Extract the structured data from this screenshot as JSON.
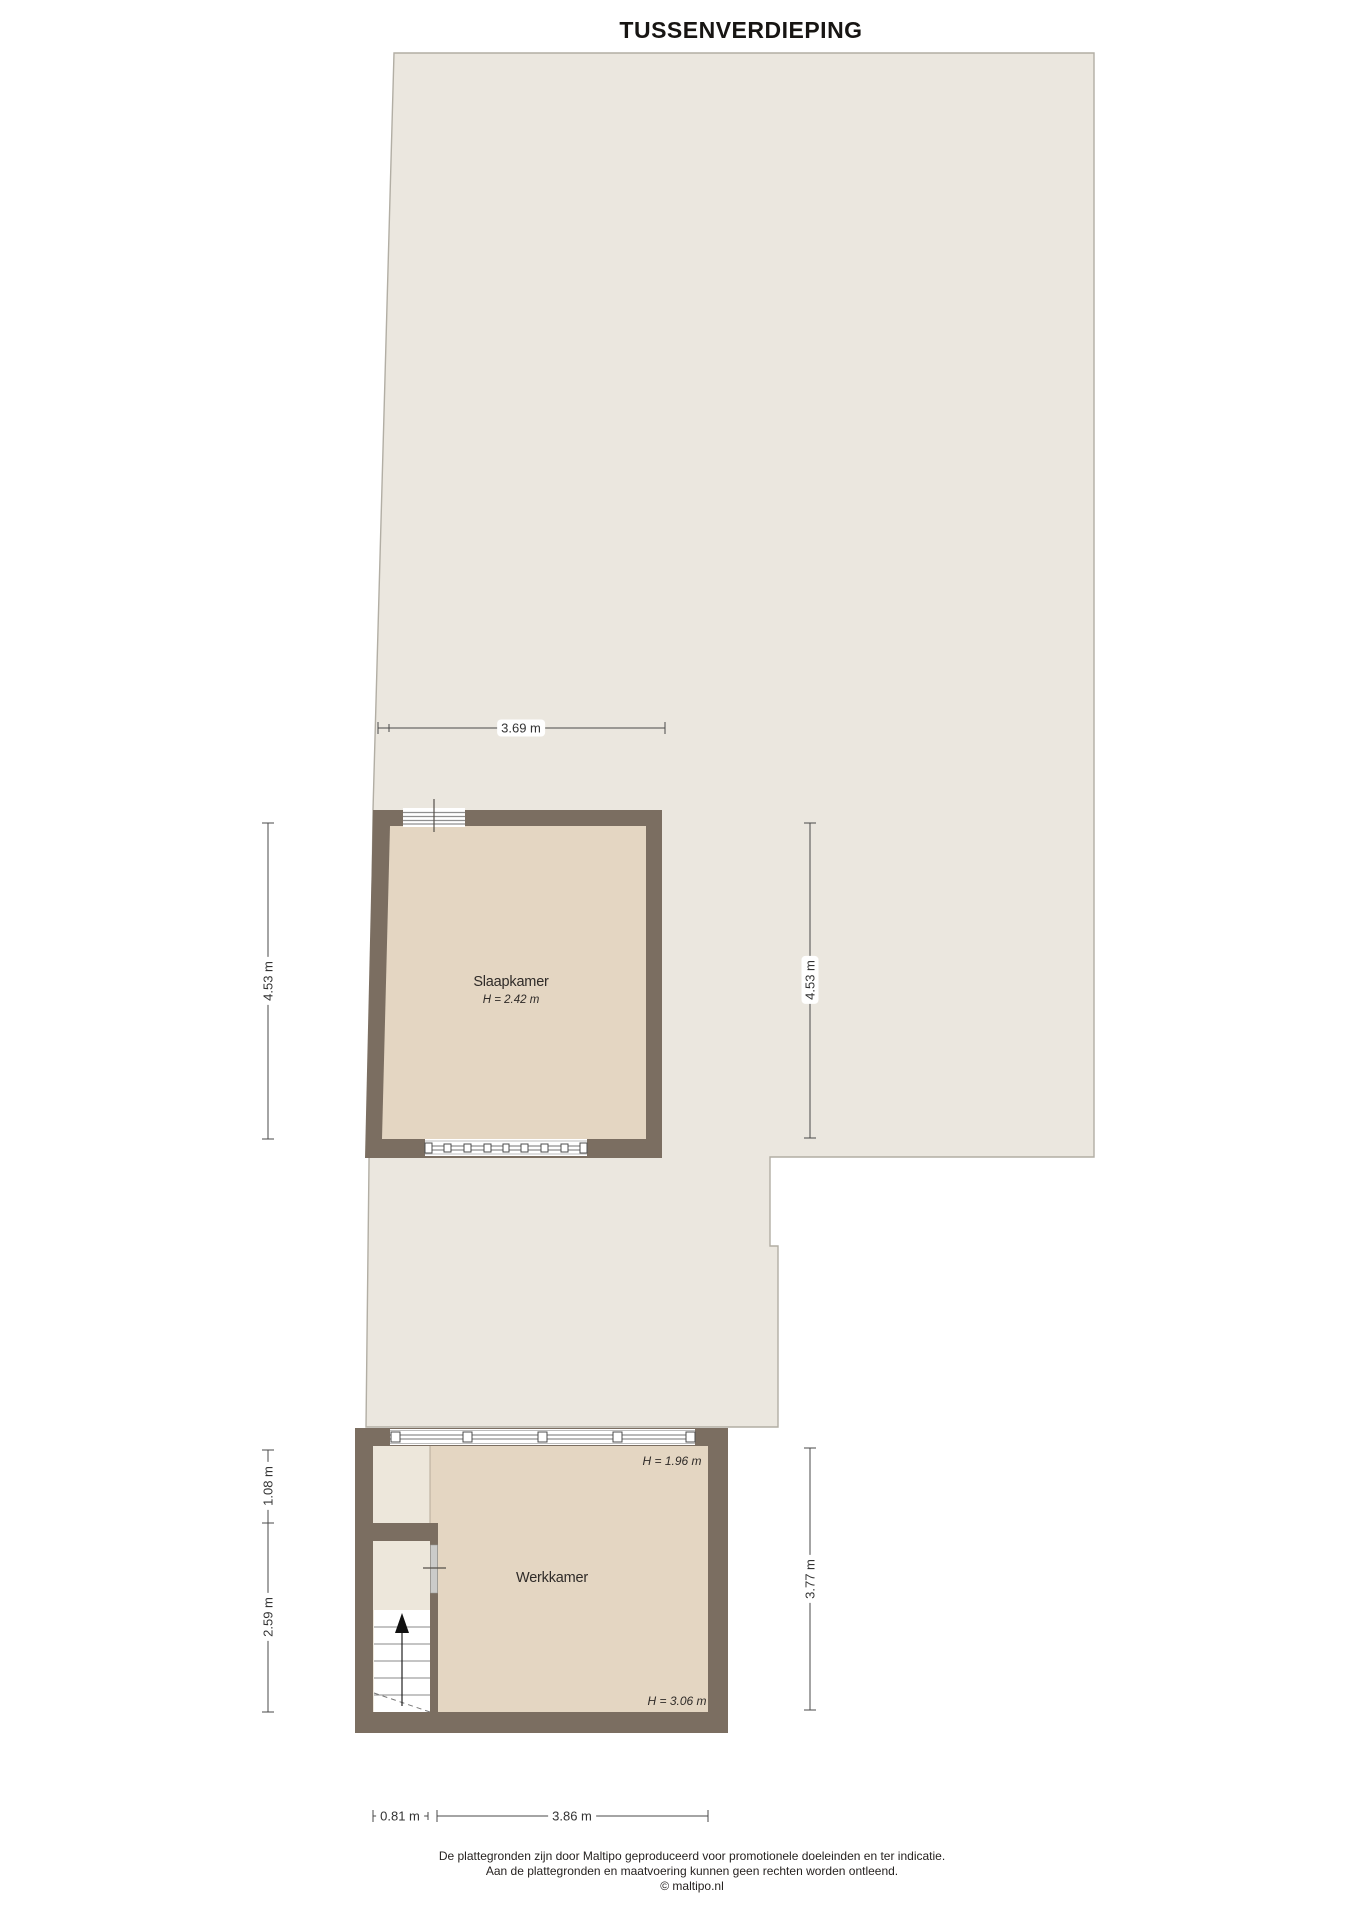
{
  "title": "TUSSENVERDIEPING",
  "rooms": {
    "slaapkamer": {
      "label": "Slaapkamer",
      "height": "H = 2.42 m"
    },
    "werkkamer": {
      "label": "Werkkamer",
      "height_top": "H = 1.96 m",
      "height_bottom": "H = 3.06 m"
    }
  },
  "dimensions": {
    "slaapkamer_width": "3.69 m",
    "slaapkamer_height_left": "4.53 m",
    "slaapkamer_height_right": "4.53 m",
    "closet_upper_height": "1.08 m",
    "closet_lower_height": "2.59 m",
    "werkkamer_height_right": "3.77 m",
    "stairwell_width": "0.81 m",
    "werkkamer_width": "3.86 m"
  },
  "footer": {
    "line1": "De plattegronden zijn door Maltipo geproduceerd voor promotionele doeleinden en ter indicatie.",
    "line2": "Aan de plattegronden en maatvoering kunnen geen rechten worden ontleend.",
    "line3": "© maltipo.nl"
  },
  "colors": {
    "floor": "#ebe7df",
    "floor_border": "#b2aea4",
    "wall": "#7b6e61",
    "room": "#e4d6c2",
    "closet": "#ede7db",
    "window_line": "#8f8f8f",
    "window_frame": "#bdbdbd",
    "dimension": "#4a4a4a",
    "text": "#2f2b28"
  }
}
